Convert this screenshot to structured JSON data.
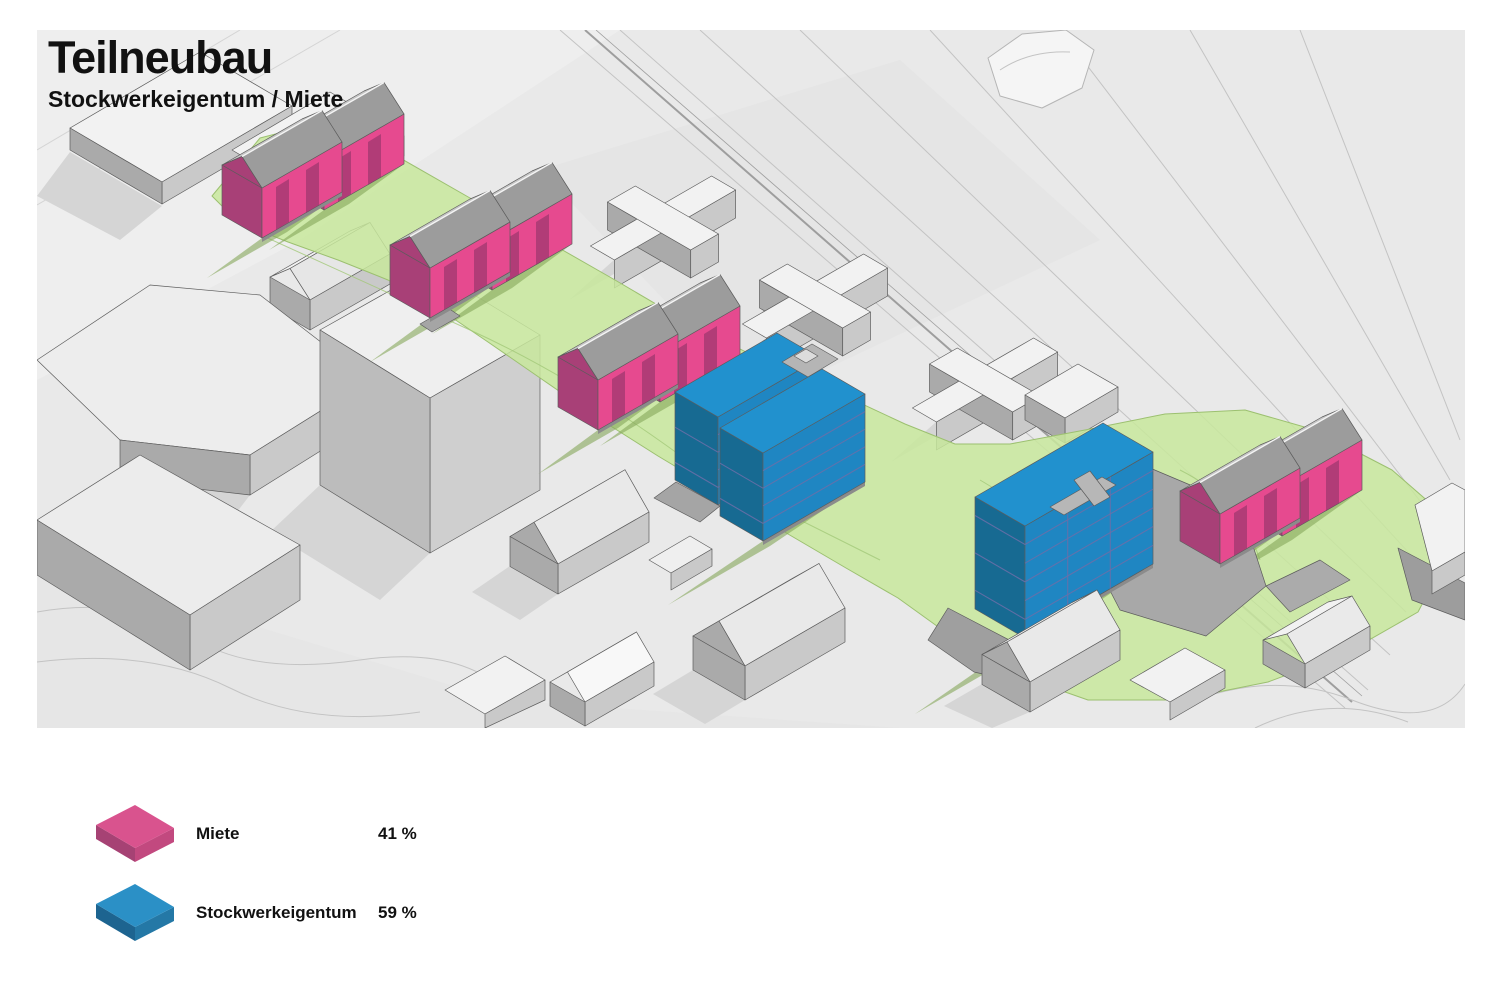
{
  "header": {
    "title": "Teilneubau",
    "subtitle": "Stockwerkeigentum / Miete"
  },
  "legend": {
    "items": [
      {
        "label": "Miete",
        "value": "41 %",
        "color_top": "#d9538e",
        "color_side": "#a64274",
        "color_front": "#c2497f"
      },
      {
        "label": "Stockwerkeigentum",
        "value": "59 %",
        "color_top": "#2b90c6",
        "color_side": "#1d6490",
        "color_front": "#2478a6"
      }
    ]
  },
  "palette": {
    "miete_facade": "#e64a8f",
    "miete_dark": "#a84077",
    "miete_window": "#8e3468",
    "stockwerk_top": "#2191ce",
    "stockwerk_front": "#1f86c2",
    "stockwerk_side": "#176a92",
    "floor_line": "#6c6fa8",
    "parcel_green": "#c8e89c",
    "parcel_shadow": "#85a65a",
    "parcel_edge": "#9cc070",
    "terrain": "#e9e9e9",
    "context_roof": "#f2f2f2",
    "context_wall": "#c9c9c9",
    "context_wall_dark": "#aaaaaa",
    "path_gray": "#a8a8a8",
    "plinth": "#8b8b8b",
    "roof_front": "#9c9c9c",
    "roof_back": "#c6c6c6",
    "outline": "#5c5c5c",
    "contour": "#c3c3c3"
  }
}
